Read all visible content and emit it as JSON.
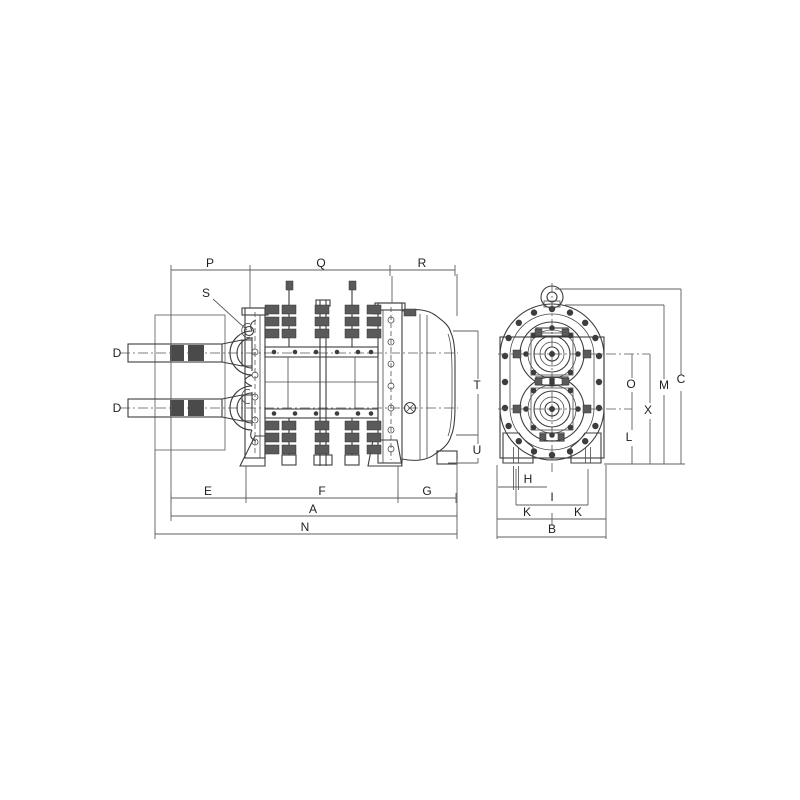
{
  "drawing": {
    "type": "engineering dimensional drawing, twin-shaft rotary blower/pump, side view and end view",
    "side_view": {
      "top_dimensions": [
        "P",
        "Q",
        "R"
      ],
      "callout": "S",
      "shaft_diameter_label": "D",
      "right_height_dimensions": [
        "T",
        "U"
      ],
      "bottom_dimensions_row1": [
        "E",
        "F",
        "G"
      ],
      "bottom_dimensions_row2": [
        "A"
      ],
      "bottom_dimensions_row3": [
        "N"
      ]
    },
    "end_view": {
      "right_dimensions": [
        "O",
        "X",
        "L",
        "M",
        "C"
      ],
      "bottom_dimensions": [
        "H",
        "I",
        "K",
        "K",
        "B"
      ]
    }
  },
  "labels": {
    "P": "P",
    "Q": "Q",
    "R": "R",
    "S": "S",
    "D": "D",
    "T": "T",
    "U": "U",
    "E": "E",
    "F": "F",
    "G": "G",
    "A": "A",
    "N": "N",
    "O": "O",
    "X": "X",
    "L": "L",
    "M": "M",
    "C": "C",
    "H": "H",
    "I": "I",
    "K": "K",
    "B": "B"
  },
  "colors": {
    "background": "#ffffff",
    "line": "#3d3d3d",
    "dimension_line": "#5f5f5f",
    "label": "#1f1f1f"
  }
}
